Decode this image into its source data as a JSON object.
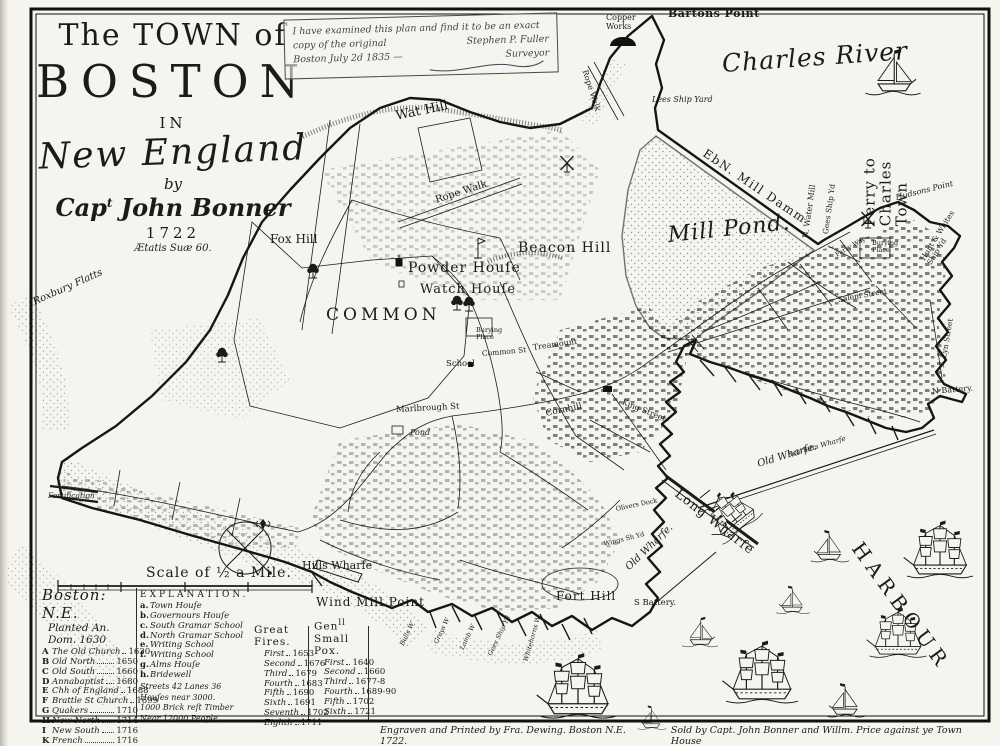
{
  "page": {
    "paper": "#f6f4ee",
    "ink": "#1b1b1b",
    "stipple": "#555555"
  },
  "title": {
    "line1": "The TOWN of",
    "line2": "BOSTON",
    "line3": "IN",
    "line4": "New England",
    "line5": "by",
    "author_pre": "Cap",
    "author_sup": "t",
    "author_name": " John Bonner",
    "year": "1722",
    "motto": "Ætatis Suæ 60."
  },
  "certificate": {
    "line1": "I have examined this plan and find it to be an exact",
    "line2a": "copy of the original",
    "line2b": "Stephen P. Fuller",
    "line3a": "Boston July 2d 1835 —",
    "line3b": "Surveyor"
  },
  "imprint": {
    "left": "Engraven and Printed by Fra. Dewing. Boston N.E. 1722.",
    "right": "Sold by Capt. John Bonner and Willm. Price against ye Town House"
  },
  "scale": {
    "label": "Scale of ½ a Mile."
  },
  "map_labels": [
    {
      "id": "bartons-point",
      "text": "Bartons Point",
      "x": 668,
      "y": 8,
      "rot": 0,
      "fs": 11,
      "cls": "plain-b",
      "ls": 0.5
    },
    {
      "id": "copper-works",
      "text": "Copper\nWorks",
      "x": 606,
      "y": 14,
      "rot": 0,
      "fs": 8,
      "cls": "tiny"
    },
    {
      "id": "charles-river",
      "text": "Charles River",
      "x": 722,
      "y": 50,
      "rot": -4,
      "fs": 25,
      "cls": "script",
      "ls": 1
    },
    {
      "id": "ferry-to-charles-town",
      "text": "Ferry to Charles Town",
      "x": 886,
      "y": 202,
      "rot": -90,
      "fs": 15,
      "cls": "plain",
      "ls": 1
    },
    {
      "id": "lees-ship-yard",
      "text": "Lees Ship Yard",
      "x": 652,
      "y": 96,
      "rot": 0,
      "fs": 8,
      "cls": "tiny-i"
    },
    {
      "id": "rope-walk-barton",
      "text": "Rope Walk",
      "x": 584,
      "y": 66,
      "rot": 72,
      "fs": 8,
      "cls": "tiny"
    },
    {
      "id": "mill-damm",
      "text": "EbN. Mill Damm",
      "x": 704,
      "y": 146,
      "rot": 34,
      "fs": 12,
      "cls": "plain",
      "ls": 1.5
    },
    {
      "id": "mill-pond",
      "text": "Mill Pond.",
      "x": 668,
      "y": 224,
      "rot": -6,
      "fs": 22,
      "cls": "script",
      "ls": 1
    },
    {
      "id": "n-water-mill",
      "text": "N. Water Mill",
      "x": 806,
      "y": 234,
      "rot": -82,
      "fs": 8,
      "cls": "tiny"
    },
    {
      "id": "gees-ship-yd-north",
      "text": "Gees Ship Yd",
      "x": 826,
      "y": 230,
      "rot": -82,
      "fs": 7.5,
      "cls": "tiny"
    },
    {
      "id": "hudsons-point",
      "text": "Hudsons Point",
      "x": 896,
      "y": 194,
      "rot": -14,
      "fs": 8,
      "cls": "tiny-i"
    },
    {
      "id": "hunt-whites-ship-yd",
      "text": "Hunt & Whites Ship Yd",
      "x": 926,
      "y": 254,
      "rot": -58,
      "fs": 7.5,
      "cls": "tiny"
    },
    {
      "id": "wat-hill",
      "text": "Wat Hill",
      "x": 396,
      "y": 110,
      "rot": -12,
      "fs": 13,
      "cls": "plain"
    },
    {
      "id": "fox-hill",
      "text": "Fox Hill",
      "x": 270,
      "y": 233,
      "rot": 0,
      "fs": 12,
      "cls": "plain"
    },
    {
      "id": "beacon-hill",
      "text": "Beacon Hill",
      "x": 518,
      "y": 241,
      "rot": 0,
      "fs": 14,
      "cls": "plain",
      "ls": 1
    },
    {
      "id": "powder-house",
      "text": "Powder Houſe",
      "x": 408,
      "y": 261,
      "rot": 0,
      "fs": 14,
      "cls": "plain",
      "ls": 1
    },
    {
      "id": "watch-house",
      "text": "Watch Houſe",
      "x": 420,
      "y": 283,
      "rot": 0,
      "fs": 13,
      "cls": "plain",
      "ls": 1
    },
    {
      "id": "common",
      "text": "COMMON",
      "x": 326,
      "y": 306,
      "rot": 0,
      "fs": 17,
      "cls": "caps",
      "ls": 4
    },
    {
      "id": "burying-place-common",
      "text": "Burying\nPlace",
      "x": 476,
      "y": 327,
      "rot": 0,
      "fs": 6.5,
      "cls": "tiny"
    },
    {
      "id": "common-st",
      "text": "Common St",
      "x": 482,
      "y": 350,
      "rot": -5,
      "fs": 7.5,
      "cls": "tiny"
    },
    {
      "id": "treamount",
      "text": "Treamount",
      "x": 533,
      "y": 344,
      "rot": -8,
      "fs": 8,
      "cls": "tiny"
    },
    {
      "id": "school",
      "text": "School",
      "x": 446,
      "y": 360,
      "rot": 0,
      "fs": 8.5,
      "cls": "tiny"
    },
    {
      "id": "marlbrough-st",
      "text": "Marlbrough St",
      "x": 396,
      "y": 406,
      "rot": -3,
      "fs": 8.5,
      "cls": "tiny"
    },
    {
      "id": "cornhill",
      "text": "Cornhill",
      "x": 546,
      "y": 410,
      "rot": -12,
      "fs": 9,
      "cls": "tiny"
    },
    {
      "id": "king-street",
      "text": "King Street",
      "x": 622,
      "y": 398,
      "rot": 22,
      "fs": 8,
      "cls": "tiny"
    },
    {
      "id": "pond",
      "text": "Pond",
      "x": 410,
      "y": 429,
      "rot": 0,
      "fs": 8,
      "cls": "tiny-i"
    },
    {
      "id": "salem-street",
      "text": "Salem Street",
      "x": 838,
      "y": 296,
      "rot": -10,
      "fs": 7.5,
      "cls": "tiny"
    },
    {
      "id": "lyn-street",
      "text": "Lyn Street",
      "x": 944,
      "y": 354,
      "rot": -80,
      "fs": 7.5,
      "cls": "tiny"
    },
    {
      "id": "burying-place-north",
      "text": "Burying\nPlace",
      "x": 872,
      "y": 240,
      "rot": 0,
      "fs": 6.5,
      "cls": "tiny"
    },
    {
      "id": "n-battery",
      "text": "N Battery.",
      "x": 932,
      "y": 388,
      "rot": -5,
      "fs": 8,
      "cls": "tiny"
    },
    {
      "id": "scarletts-wharfe",
      "text": "Scarletts Wharfe",
      "x": 788,
      "y": 452,
      "rot": -16,
      "fs": 7,
      "cls": "tiny-i"
    },
    {
      "id": "old-wharfe-1",
      "text": "Old Wharfe.",
      "x": 758,
      "y": 460,
      "rot": -17,
      "fs": 10,
      "cls": "plain-i"
    },
    {
      "id": "long-wharfe",
      "text": "Long Wharfe",
      "x": 676,
      "y": 486,
      "rot": 38,
      "fs": 13,
      "cls": "plain",
      "ls": 1
    },
    {
      "id": "old-wharfe-2",
      "text": "Old Wharfe.",
      "x": 628,
      "y": 564,
      "rot": -44,
      "fs": 10,
      "cls": "plain-i"
    },
    {
      "id": "hills-wharfe",
      "text": "Hills Wharfe",
      "x": 302,
      "y": 560,
      "rot": 0,
      "fs": 11,
      "cls": "plain"
    },
    {
      "id": "wind-mill-point",
      "text": "Wind Mill Point",
      "x": 316,
      "y": 596,
      "rot": 0,
      "fs": 12,
      "cls": "plain",
      "ls": 1
    },
    {
      "id": "fort-hill",
      "text": "Fort Hill",
      "x": 556,
      "y": 590,
      "rot": 0,
      "fs": 12,
      "cls": "plain",
      "ls": 1
    },
    {
      "id": "s-battery",
      "text": "S Battery.",
      "x": 634,
      "y": 599,
      "rot": 0,
      "fs": 8.5,
      "cls": "tiny"
    },
    {
      "id": "harbour",
      "text": "HARBOUR",
      "x": 856,
      "y": 534,
      "rot": 54,
      "fs": 20,
      "cls": "caps",
      "ls": 6
    },
    {
      "id": "roxbury-flatts",
      "text": "Roxbury Flatts",
      "x": 34,
      "y": 298,
      "rot": -24,
      "fs": 10,
      "cls": "script-sm"
    },
    {
      "id": "fortification",
      "text": "Fortification",
      "x": 48,
      "y": 492,
      "rot": 0,
      "fs": 7.5,
      "cls": "tiny-i"
    },
    {
      "id": "olivers-dock",
      "text": "Olivers Dock",
      "x": 616,
      "y": 506,
      "rot": -12,
      "fs": 6.5,
      "cls": "tiny"
    },
    {
      "id": "wings-ship-yd",
      "text": "Wings Sh Yd",
      "x": 604,
      "y": 541,
      "rot": -14,
      "fs": 6.5,
      "cls": "tiny"
    },
    {
      "id": "bulls-wharf",
      "text": "Bulls W",
      "x": 402,
      "y": 642,
      "rot": -64,
      "fs": 6.5,
      "cls": "tiny-i"
    },
    {
      "id": "grays-wharf",
      "text": "Grays W",
      "x": 436,
      "y": 640,
      "rot": -64,
      "fs": 6.5,
      "cls": "tiny-i"
    },
    {
      "id": "lamb-wharf",
      "text": "Lamb W",
      "x": 462,
      "y": 646,
      "rot": -64,
      "fs": 6.5,
      "cls": "tiny-i"
    },
    {
      "id": "gees-ship-yd-south",
      "text": "Gees Ship Yd",
      "x": 490,
      "y": 652,
      "rot": -64,
      "fs": 6.5,
      "cls": "tiny-i"
    },
    {
      "id": "whitehorns-wharf",
      "text": "Whitehorns W",
      "x": 526,
      "y": 658,
      "rot": -74,
      "fs": 6.5,
      "cls": "tiny-i"
    },
    {
      "id": "ferry-way",
      "text": "Ferry Way",
      "x": 836,
      "y": 252,
      "rot": -30,
      "fs": 6.5,
      "cls": "tiny"
    },
    {
      "id": "rope-walk-center",
      "text": "Rope Walk",
      "x": 436,
      "y": 196,
      "rot": -18,
      "fs": 10,
      "cls": "plain"
    }
  ],
  "legend": {
    "churches_script": "Boston: N.E.",
    "churches_sub": "Planted An. Dom. 1630",
    "churches": [
      {
        "key": "A",
        "name": "The Old Church",
        "year": "1630"
      },
      {
        "key": "B",
        "name": "Old North",
        "year": "1650"
      },
      {
        "key": "C",
        "name": "Old South",
        "year": "1660"
      },
      {
        "key": "D",
        "name": "Annabaptist",
        "year": "1680"
      },
      {
        "key": "E",
        "name": "Chh of England",
        "year": "1688"
      },
      {
        "key": "F",
        "name": "Brattle St Church",
        "year": "1699"
      },
      {
        "key": "G",
        "name": "Quakers",
        "year": "1710"
      },
      {
        "key": "H",
        "name": "New North",
        "year": "1714"
      },
      {
        "key": "I",
        "name": "New South",
        "year": "1716"
      },
      {
        "key": "K",
        "name": "French",
        "year": "1716"
      },
      {
        "key": "L",
        "name": "New No. Brick",
        "year": "1721"
      }
    ],
    "explanation_title": "EXPLANATION.",
    "explanation": [
      {
        "key": "a.",
        "name": "Town Houſe"
      },
      {
        "key": "b.",
        "name": "Governours Houſe"
      },
      {
        "key": "c.",
        "name": "South Gramar School"
      },
      {
        "key": "d.",
        "name": "North Gramar School"
      },
      {
        "key": "e.",
        "name": "Writing School"
      },
      {
        "key": "f.",
        "name": "Writing School"
      },
      {
        "key": "g.",
        "name": "Alms Houſe"
      },
      {
        "key": "h.",
        "name": "Bridewell"
      }
    ],
    "notes": [
      "Streets 42 Lanes 36",
      "Houſes near 3000.",
      "1000 Brick reſt Timber",
      "Near 12000 People."
    ],
    "fires": {
      "title": "Great Fires.",
      "rows": [
        {
          "name": "First",
          "year": "1653"
        },
        {
          "name": "Second",
          "year": "1676"
        },
        {
          "name": "Third",
          "year": "1679"
        },
        {
          "name": "Fourth",
          "year": "1683"
        },
        {
          "name": "Fifth",
          "year": "1690"
        },
        {
          "name": "Sixth",
          "year": "1691"
        },
        {
          "name": "Seventh",
          "year": "1702"
        },
        {
          "name": "Eighth",
          "year": "1711"
        }
      ]
    },
    "pox": {
      "title_main": "Gen",
      "title_sup": "ll",
      "title_rest": "Small Pox.",
      "rows": [
        {
          "name": "First",
          "year": "1640"
        },
        {
          "name": "Second",
          "year": "1660"
        },
        {
          "name": "Third",
          "year": "1677-8"
        },
        {
          "name": "Fourth",
          "year": "1689-90"
        },
        {
          "name": "Fifth",
          "year": "1702"
        },
        {
          "name": "Sixth",
          "year": "1721"
        }
      ]
    }
  },
  "ships": [
    {
      "x": 893,
      "y": 92,
      "s": 1.15,
      "t": "sloop",
      "flip": true
    },
    {
      "x": 742,
      "y": 528,
      "s": 0.85,
      "t": "ship",
      "rot": -38
    },
    {
      "x": 830,
      "y": 560,
      "s": 0.8,
      "t": "sloop"
    },
    {
      "x": 793,
      "y": 612,
      "s": 0.7,
      "t": "sloop"
    },
    {
      "x": 700,
      "y": 645,
      "s": 0.75,
      "t": "sloop",
      "flip": true
    },
    {
      "x": 762,
      "y": 700,
      "s": 1.2,
      "t": "ship"
    },
    {
      "x": 898,
      "y": 655,
      "s": 0.95,
      "t": "ship"
    },
    {
      "x": 940,
      "y": 575,
      "s": 1.1,
      "t": "ship"
    },
    {
      "x": 578,
      "y": 715,
      "s": 1.25,
      "t": "ship"
    },
    {
      "x": 652,
      "y": 728,
      "s": 0.6,
      "t": "sloop"
    },
    {
      "x": 846,
      "y": 715,
      "s": 0.85,
      "t": "sloop"
    }
  ],
  "trees": [
    {
      "x": 313,
      "y": 278
    },
    {
      "x": 457,
      "y": 310
    },
    {
      "x": 469,
      "y": 311
    },
    {
      "x": 222,
      "y": 362
    }
  ],
  "windmills": [
    {
      "x": 567,
      "y": 172
    },
    {
      "x": 868,
      "y": 228
    }
  ]
}
